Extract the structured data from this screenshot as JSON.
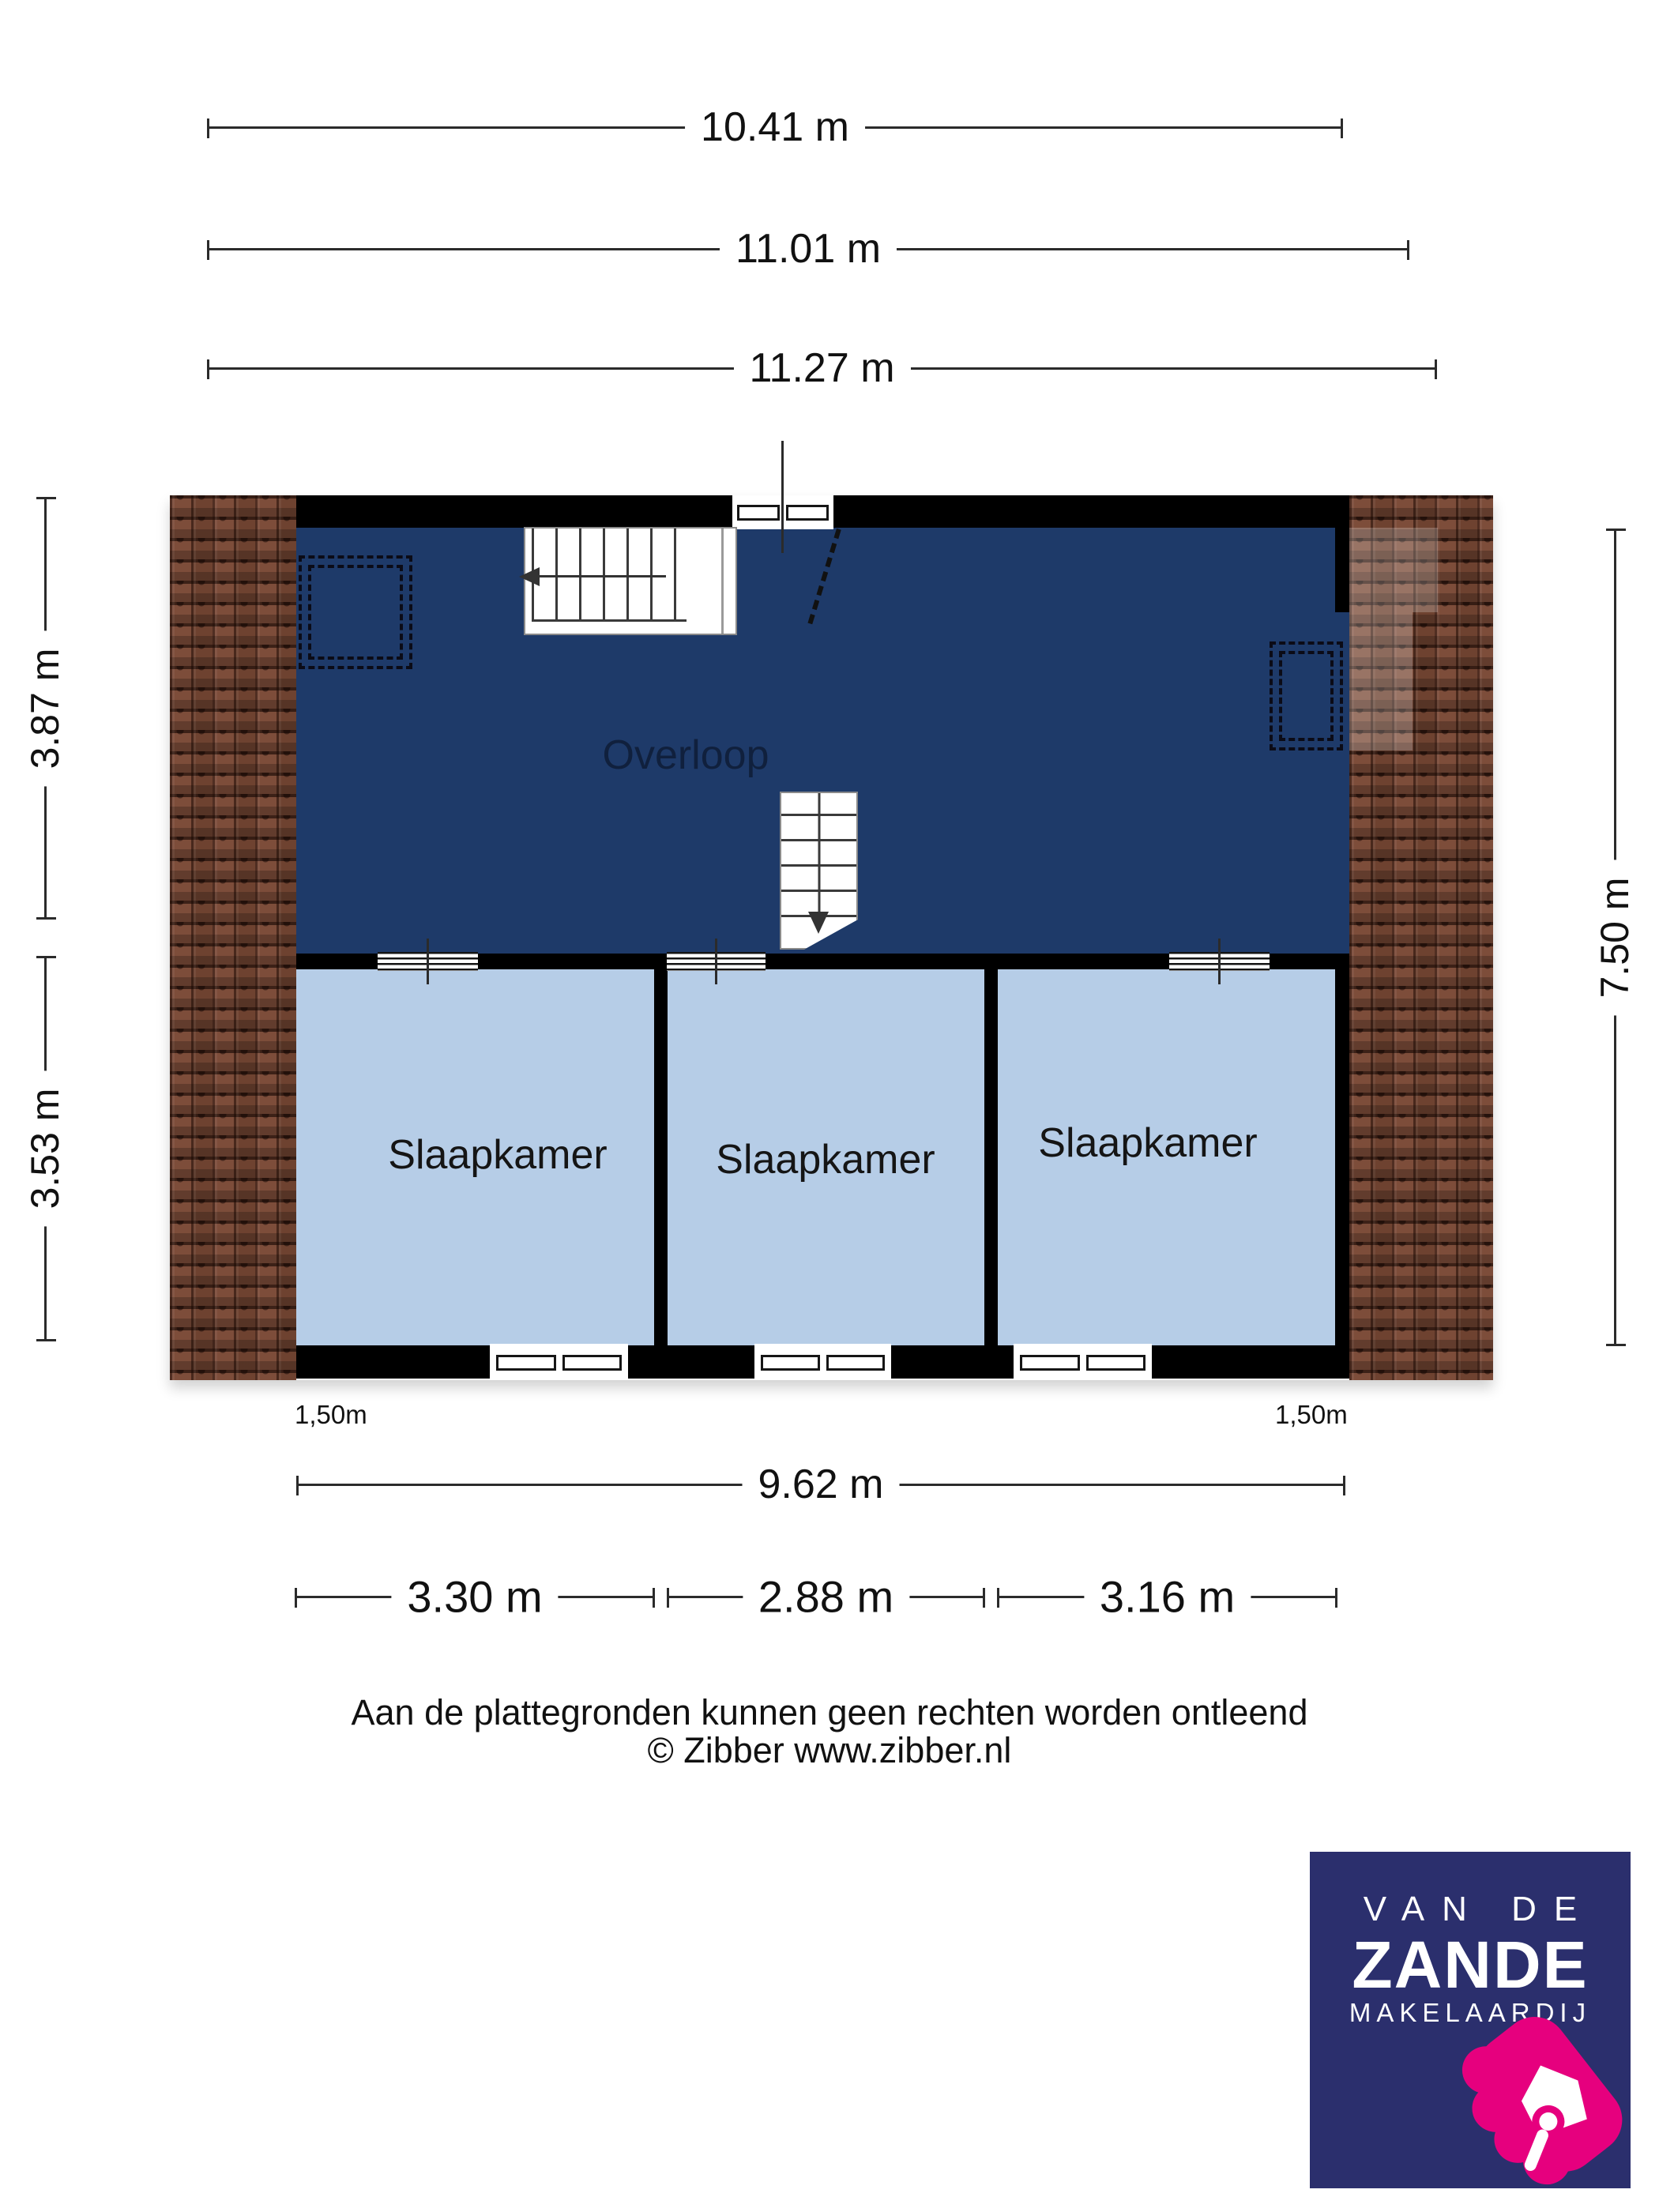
{
  "dims": {
    "top": [
      "10.41 m",
      "11.01 m",
      "11.27 m"
    ],
    "left": [
      "3.87 m",
      "3.53 m"
    ],
    "right": "7.50 m",
    "total_width": "9.62 m",
    "room_widths": [
      "3.30 m",
      "2.88 m",
      "3.16 m"
    ],
    "headroom_left": "1,50m",
    "headroom_right": "1,50m"
  },
  "rooms": {
    "landing": "Overloop",
    "bedroom_1": "Slaapkamer",
    "bedroom_2": "Slaapkamer",
    "bedroom_3": "Slaapkamer"
  },
  "footer": {
    "disclaimer": "Aan de plattegronden kunnen geen rechten worden ontleend",
    "copyright": "© Zibber www.zibber.nl"
  },
  "logo": {
    "top": "VAN DE",
    "name": "ZANDE",
    "subtitle": "MAKELAARDIJ"
  },
  "colors": {
    "landing_floor": "#1e3a69",
    "bedroom_floor": "#b6cde7",
    "wall": "#000000",
    "roof_tile": "#7b4a38",
    "logo_bg": "#2b2f6d",
    "logo_pink": "#e6007e"
  }
}
